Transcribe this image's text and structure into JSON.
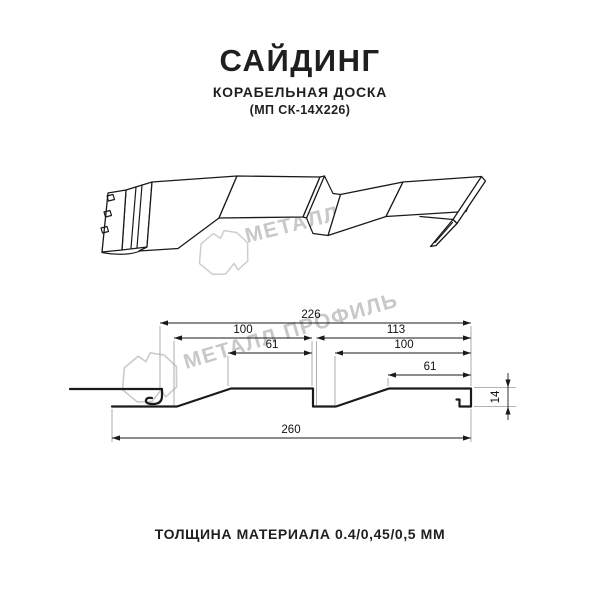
{
  "title": {
    "main": "САЙДИНГ",
    "subtitle": "КОРАБЕЛЬНАЯ ДОСКА",
    "code": "(МП СК-14Х226)"
  },
  "footer": {
    "thickness_label": "ТОЛЩИНА МАТЕРИАЛА 0.4/0,45/0,5 ММ"
  },
  "watermark": {
    "text": "МЕТАЛЛ ПРОФИЛЬ",
    "color": "#c8c8c8"
  },
  "drawing": {
    "line_color": "#1a1a1a",
    "dimensions": {
      "panel_width": "226",
      "pane1_width": "100",
      "pane2_width": "113",
      "pane1_flat": "61",
      "pane2_flat": "100",
      "pane2_flat_top": "61",
      "overall_width": "260",
      "profile_height": "14"
    }
  }
}
